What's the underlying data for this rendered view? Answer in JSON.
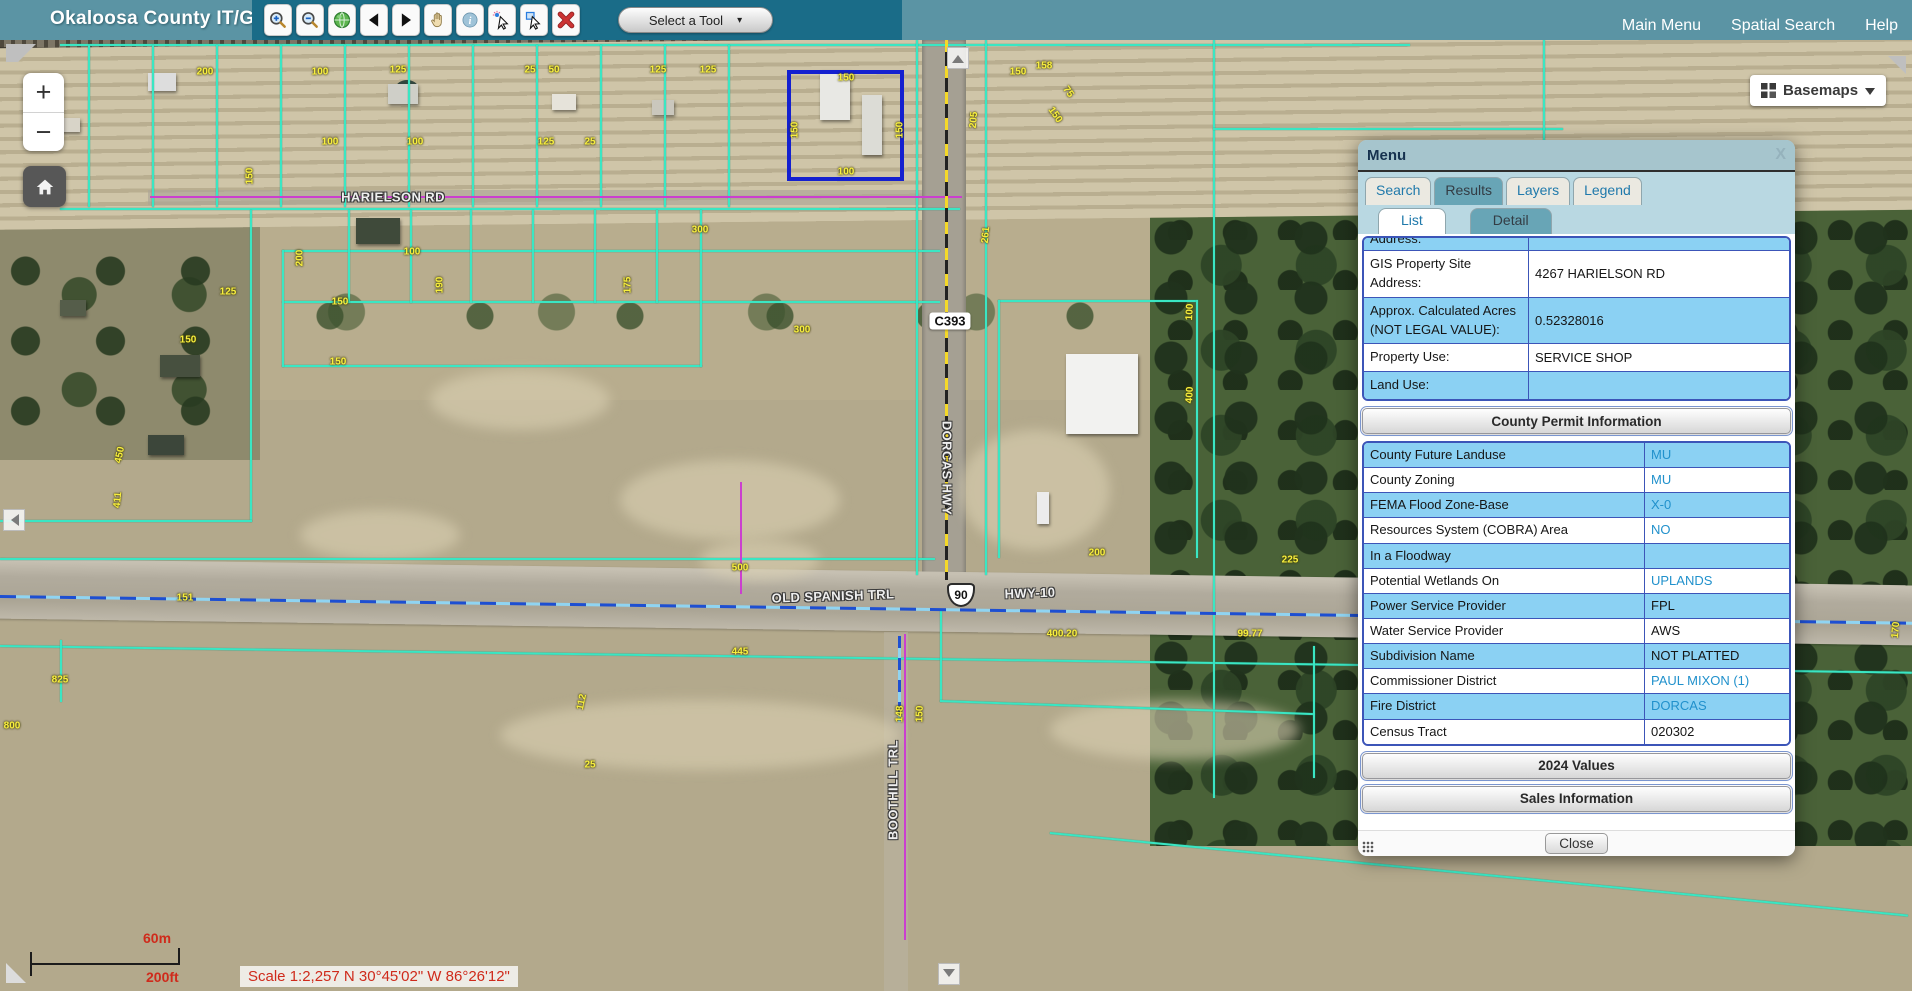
{
  "top_bar": {
    "title": "Okaloosa County IT/GIS",
    "tools": [
      {
        "name": "zoom-in-tool",
        "icon": "zoomin"
      },
      {
        "name": "zoom-out-tool",
        "icon": "zoomout"
      },
      {
        "name": "full-extent-tool",
        "icon": "globe"
      },
      {
        "name": "previous-extent-tool",
        "icon": "prev"
      },
      {
        "name": "next-extent-tool",
        "icon": "next"
      },
      {
        "name": "pan-tool",
        "icon": "pan"
      },
      {
        "name": "identify-tool",
        "icon": "info"
      },
      {
        "name": "select-features-tool",
        "icon": "selpoint"
      },
      {
        "name": "select-by-rectangle-tool",
        "icon": "selbox"
      },
      {
        "name": "clear-selection-tool",
        "icon": "clear"
      }
    ],
    "tool_select_label": "Select a Tool",
    "links": [
      "Main Menu",
      "Spatial Search",
      "Help"
    ]
  },
  "map": {
    "zoom_in_label": "+",
    "zoom_out_label": "−",
    "basemaps_label": "Basemaps",
    "scale": {
      "metric": "60m",
      "imperial": "200ft",
      "text": "Scale 1:2,257  N 30°45'02\"  W 86°26'12\""
    },
    "road_labels": [
      {
        "text": "HARIELSON RD",
        "x": 393,
        "y": 197,
        "rot": 0,
        "style": "road"
      },
      {
        "text": "C393",
        "x": 950,
        "y": 321,
        "style": "badge"
      },
      {
        "text": "DORCAS HWY",
        "x": 947,
        "y": 468,
        "rot": 90,
        "style": "road"
      },
      {
        "text": "OLD SPANISH TRL",
        "x": 833,
        "y": 596,
        "rot": -2,
        "style": "road"
      },
      {
        "text": "90",
        "x": 961,
        "y": 595,
        "style": "shield"
      },
      {
        "text": "HWY-10",
        "x": 1030,
        "y": 593,
        "rot": -2,
        "style": "road"
      },
      {
        "text": "BOOTHILL TRL",
        "x": 893,
        "y": 790,
        "rot": -90,
        "style": "road"
      }
    ],
    "parcel_labels": [
      {
        "t": "200",
        "x": 205,
        "y": 72
      },
      {
        "t": "100",
        "x": 320,
        "y": 72
      },
      {
        "t": "125",
        "x": 398,
        "y": 70
      },
      {
        "t": "25",
        "x": 530,
        "y": 70
      },
      {
        "t": "50",
        "x": 554,
        "y": 70
      },
      {
        "t": "125",
        "x": 658,
        "y": 70
      },
      {
        "t": "125",
        "x": 708,
        "y": 70
      },
      {
        "t": "150",
        "x": 846,
        "y": 78
      },
      {
        "t": "150",
        "x": 1018,
        "y": 72
      },
      {
        "t": "158",
        "x": 1044,
        "y": 66
      },
      {
        "t": "75",
        "x": 1068,
        "y": 92,
        "r": 55
      },
      {
        "t": "150",
        "x": 795,
        "y": 130,
        "r": -90
      },
      {
        "t": "150",
        "x": 900,
        "y": 130,
        "r": -90
      },
      {
        "t": "100",
        "x": 846,
        "y": 172
      },
      {
        "t": "100",
        "x": 330,
        "y": 142
      },
      {
        "t": "100",
        "x": 415,
        "y": 142
      },
      {
        "t": "125",
        "x": 546,
        "y": 142
      },
      {
        "t": "25",
        "x": 590,
        "y": 142
      },
      {
        "t": "150",
        "x": 250,
        "y": 176,
        "r": -90
      },
      {
        "t": "450",
        "x": 120,
        "y": 455,
        "r": -78
      },
      {
        "t": "411",
        "x": 118,
        "y": 500,
        "r": -85
      },
      {
        "t": "125",
        "x": 228,
        "y": 292
      },
      {
        "t": "150",
        "x": 188,
        "y": 340
      },
      {
        "t": "200",
        "x": 300,
        "y": 258,
        "r": -90
      },
      {
        "t": "100",
        "x": 412,
        "y": 252
      },
      {
        "t": "300",
        "x": 700,
        "y": 230
      },
      {
        "t": "150",
        "x": 340,
        "y": 302
      },
      {
        "t": "190",
        "x": 440,
        "y": 285,
        "r": -90
      },
      {
        "t": "175",
        "x": 628,
        "y": 285,
        "r": -90
      },
      {
        "t": "300",
        "x": 802,
        "y": 330
      },
      {
        "t": "150",
        "x": 338,
        "y": 362
      },
      {
        "t": "205",
        "x": 974,
        "y": 120,
        "r": -85
      },
      {
        "t": "261",
        "x": 986,
        "y": 235,
        "r": -85
      },
      {
        "t": "150",
        "x": 1055,
        "y": 115,
        "r": 55
      },
      {
        "t": "400",
        "x": 1190,
        "y": 395,
        "r": -87
      },
      {
        "t": "100",
        "x": 1190,
        "y": 312,
        "r": -87
      },
      {
        "t": "200",
        "x": 1097,
        "y": 553
      },
      {
        "t": "225",
        "x": 1290,
        "y": 560
      },
      {
        "t": "500",
        "x": 740,
        "y": 568
      },
      {
        "t": "445",
        "x": 740,
        "y": 652
      },
      {
        "t": "400.20",
        "x": 1062,
        "y": 634
      },
      {
        "t": "99.77",
        "x": 1250,
        "y": 634
      },
      {
        "t": "173",
        "x": 1432,
        "y": 645,
        "r": -85
      },
      {
        "t": "112",
        "x": 582,
        "y": 702,
        "r": -78
      },
      {
        "t": "25",
        "x": 590,
        "y": 765
      },
      {
        "t": "825",
        "x": 60,
        "y": 680
      },
      {
        "t": "800",
        "x": 12,
        "y": 726
      },
      {
        "t": "151",
        "x": 185,
        "y": 598
      },
      {
        "t": "148",
        "x": 900,
        "y": 714,
        "r": -88
      },
      {
        "t": "150",
        "x": 920,
        "y": 714,
        "r": -88
      },
      {
        "t": "208.52",
        "x": 1420,
        "y": 712,
        "r": -85
      },
      {
        "t": "25",
        "x": 1548,
        "y": 738,
        "r": -55
      },
      {
        "t": "75",
        "x": 1556,
        "y": 764,
        "r": -55
      },
      {
        "t": "170",
        "x": 1896,
        "y": 630,
        "r": -85
      }
    ],
    "lines": [
      {
        "x": 60,
        "y": 44,
        "w": 1350,
        "h": 2,
        "c": "cy"
      },
      {
        "x": 88,
        "y": 45,
        "w": 2,
        "h": 162,
        "c": "cy"
      },
      {
        "x": 152,
        "y": 45,
        "w": 2,
        "h": 162,
        "c": "cy"
      },
      {
        "x": 216,
        "y": 45,
        "w": 2,
        "h": 162,
        "c": "cy"
      },
      {
        "x": 280,
        "y": 45,
        "w": 2,
        "h": 162,
        "c": "cy"
      },
      {
        "x": 344,
        "y": 45,
        "w": 2,
        "h": 162,
        "c": "cy"
      },
      {
        "x": 408,
        "y": 45,
        "w": 2,
        "h": 162,
        "c": "cy"
      },
      {
        "x": 472,
        "y": 45,
        "w": 2,
        "h": 162,
        "c": "cy"
      },
      {
        "x": 536,
        "y": 45,
        "w": 2,
        "h": 162,
        "c": "cy"
      },
      {
        "x": 600,
        "y": 45,
        "w": 2,
        "h": 162,
        "c": "cy"
      },
      {
        "x": 664,
        "y": 45,
        "w": 2,
        "h": 162,
        "c": "cy"
      },
      {
        "x": 728,
        "y": 45,
        "w": 2,
        "h": 162,
        "c": "cy"
      },
      {
        "x": 60,
        "y": 208,
        "w": 900,
        "h": 2,
        "c": "cy"
      },
      {
        "x": 282,
        "y": 250,
        "w": 658,
        "h": 2,
        "c": "cy"
      },
      {
        "x": 282,
        "y": 301,
        "w": 658,
        "h": 2,
        "c": "cy"
      },
      {
        "x": 282,
        "y": 365,
        "w": 420,
        "h": 2,
        "c": "cy"
      },
      {
        "x": 282,
        "y": 250,
        "w": 2,
        "h": 117,
        "c": "cy"
      },
      {
        "x": 348,
        "y": 210,
        "w": 2,
        "h": 93,
        "c": "cy"
      },
      {
        "x": 410,
        "y": 210,
        "w": 2,
        "h": 93,
        "c": "cy"
      },
      {
        "x": 470,
        "y": 210,
        "w": 2,
        "h": 93,
        "c": "cy"
      },
      {
        "x": 532,
        "y": 210,
        "w": 2,
        "h": 93,
        "c": "cy"
      },
      {
        "x": 594,
        "y": 210,
        "w": 2,
        "h": 93,
        "c": "cy"
      },
      {
        "x": 656,
        "y": 210,
        "w": 2,
        "h": 93,
        "c": "cy"
      },
      {
        "x": 700,
        "y": 210,
        "w": 2,
        "h": 157,
        "c": "cy"
      },
      {
        "x": 250,
        "y": 210,
        "w": 2,
        "h": 312,
        "c": "cy"
      },
      {
        "x": 0,
        "y": 520,
        "w": 252,
        "h": 2,
        "c": "cy"
      },
      {
        "x": 0,
        "y": 558,
        "w": 935,
        "h": 2,
        "c": "cy"
      },
      {
        "x": 0,
        "y": 645,
        "w": 1912,
        "h": 2,
        "c": "cy",
        "r": 0.8
      },
      {
        "x": 916,
        "y": 40,
        "w": 2,
        "h": 535,
        "c": "cy"
      },
      {
        "x": 985,
        "y": 40,
        "w": 2,
        "h": 535,
        "c": "cy"
      },
      {
        "x": 1213,
        "y": 40,
        "w": 2,
        "h": 758,
        "c": "cy"
      },
      {
        "x": 1213,
        "y": 128,
        "w": 350,
        "h": 2,
        "c": "cy"
      },
      {
        "x": 1543,
        "y": 40,
        "w": 2,
        "h": 145,
        "c": "cy"
      },
      {
        "x": 998,
        "y": 300,
        "w": 200,
        "h": 2,
        "c": "cy"
      },
      {
        "x": 998,
        "y": 300,
        "w": 2,
        "h": 258,
        "c": "cy"
      },
      {
        "x": 1196,
        "y": 300,
        "w": 2,
        "h": 258,
        "c": "cy"
      },
      {
        "x": 940,
        "y": 610,
        "w": 2,
        "h": 92,
        "c": "cy"
      },
      {
        "x": 940,
        "y": 700,
        "w": 375,
        "h": 2,
        "c": "cy",
        "r": 2
      },
      {
        "x": 1313,
        "y": 646,
        "w": 2,
        "h": 132,
        "c": "cy"
      },
      {
        "x": 1050,
        "y": 832,
        "w": 862,
        "h": 2,
        "c": "cy",
        "r": 5.5
      },
      {
        "x": 60,
        "y": 640,
        "w": 2,
        "h": 62,
        "c": "cy"
      },
      {
        "x": 150,
        "y": 196,
        "w": 812,
        "h": 2,
        "c": "mg"
      },
      {
        "x": 904,
        "y": 634,
        "w": 2,
        "h": 306,
        "c": "mg"
      },
      {
        "x": 740,
        "y": 482,
        "w": 2,
        "h": 112,
        "c": "mg"
      },
      {
        "x": 945,
        "y": 40,
        "w": 3,
        "h": 540,
        "c": "yd"
      },
      {
        "x": 0,
        "y": 595,
        "w": 1920,
        "h": 3,
        "c": "bd",
        "r": 0.8
      },
      {
        "x": 898,
        "y": 636,
        "w": 3,
        "h": 86,
        "c": "bdv"
      }
    ]
  },
  "panel": {
    "title": "Menu",
    "close_x": "X",
    "tabs": [
      {
        "label": "Search",
        "active": false
      },
      {
        "label": "Results",
        "active": true
      },
      {
        "label": "Layers",
        "active": false
      },
      {
        "label": "Legend",
        "active": false
      }
    ],
    "subtabs": [
      {
        "label": "List",
        "active": false
      },
      {
        "label": "Detail",
        "active": true
      }
    ],
    "table1": [
      {
        "label": "Address:",
        "value": "",
        "shade": true,
        "clipped": true
      },
      {
        "label": "GIS Property Site Address:",
        "value": "4267 HARIELSON RD",
        "shade": false
      },
      {
        "label": "Approx. Calculated Acres (NOT LEGAL VALUE):",
        "value": "0.52328016",
        "shade": true
      },
      {
        "label": "Property Use:",
        "value": "SERVICE SHOP",
        "shade": false
      },
      {
        "label": "Land Use:",
        "value": "",
        "shade": true
      }
    ],
    "buttons": {
      "permit": "County Permit Information",
      "values": "2024 Values",
      "sales": "Sales Information"
    },
    "table2": [
      {
        "label": "County Future Landuse",
        "value": "MU",
        "shade": true,
        "link": true
      },
      {
        "label": "County Zoning",
        "value": "MU",
        "shade": false,
        "link": true
      },
      {
        "label": "FEMA Flood Zone-Base",
        "value": "X-0",
        "shade": true,
        "link": true
      },
      {
        "label": "Resources System (COBRA) Area",
        "value": "NO",
        "shade": false,
        "link": true
      },
      {
        "label": "In a Floodway",
        "value": "",
        "shade": true
      },
      {
        "label": "Potential Wetlands On",
        "value": "UPLANDS",
        "shade": false,
        "link": true
      },
      {
        "label": "Power Service Provider",
        "value": "FPL",
        "shade": true
      },
      {
        "label": "Water Service Provider",
        "value": "AWS",
        "shade": false
      },
      {
        "label": "Subdivision Name",
        "value": "NOT PLATTED",
        "shade": true
      },
      {
        "label": "Commissioner District",
        "value": "PAUL MIXON (1)",
        "shade": false,
        "link": true
      },
      {
        "label": "Fire District",
        "value": "DORCAS",
        "shade": true,
        "link": true
      },
      {
        "label": "Census Tract",
        "value": "020302",
        "shade": false
      }
    ],
    "close_label": "Close"
  }
}
